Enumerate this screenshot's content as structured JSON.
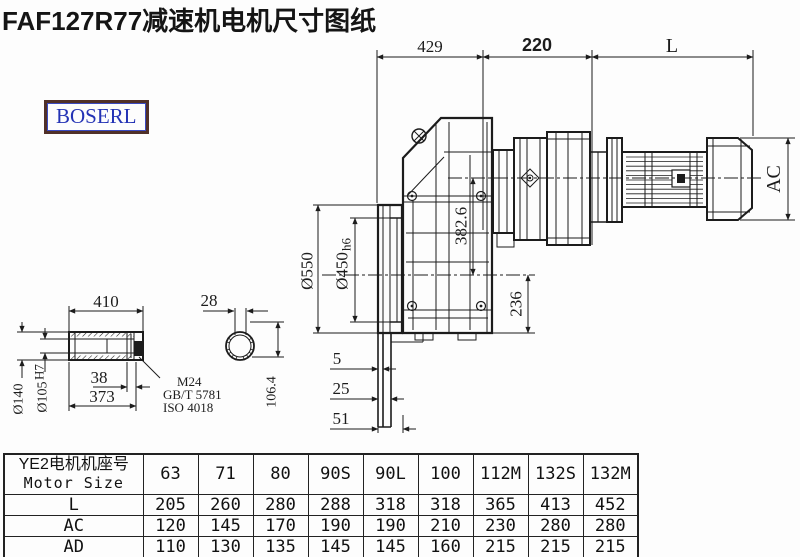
{
  "title": "FAF127R77减速机电机尺寸图纸",
  "logo": {
    "text": "BOSERL"
  },
  "colors": {
    "line": "#1c1c1c",
    "logo_border": "#503029",
    "logo_text": "#2433b5",
    "title_text": "#151515"
  },
  "drawing": {
    "dims_top": {
      "d429": "429",
      "d220": "220",
      "dL": "L"
    },
    "dims_main": {
      "ac": "AC",
      "d382": "382.6",
      "d236": "236",
      "d550": "Ø550",
      "d450": "Ø450",
      "d450_tol": "h6",
      "d5": "5",
      "d25": "25",
      "d51": "51"
    },
    "shaft_view": {
      "d410": "410",
      "d38": "38",
      "d373": "373",
      "d140": "Ø140",
      "d105": "Ø105",
      "d105_tol": "H7",
      "m24": "M24",
      "gbt": "GB/T 5781",
      "iso": "ISO 4018",
      "d28": "28",
      "d106": "106.4"
    }
  },
  "table": {
    "header_cn": "YE2电机机座号",
    "header_en": "Motor Size",
    "columns": [
      "63",
      "71",
      "80",
      "90S",
      "90L",
      "100",
      "112M",
      "132S",
      "132M"
    ],
    "rows": [
      {
        "label": "L",
        "values": [
          "205",
          "260",
          "280",
          "288",
          "318",
          "318",
          "365",
          "413",
          "452"
        ]
      },
      {
        "label": "AC",
        "values": [
          "120",
          "145",
          "170",
          "190",
          "190",
          "210",
          "230",
          "280",
          "280"
        ]
      },
      {
        "label": "AD",
        "values": [
          "110",
          "130",
          "135",
          "145",
          "145",
          "160",
          "215",
          "215",
          "215"
        ]
      }
    ]
  }
}
